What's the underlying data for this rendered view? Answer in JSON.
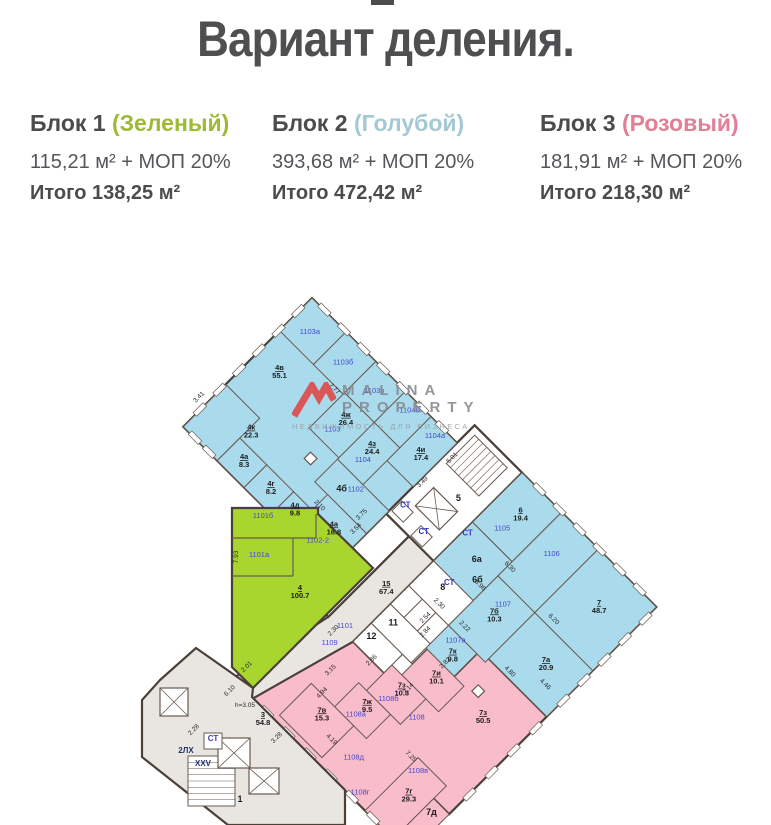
{
  "header": {
    "title": "Вариант деления."
  },
  "blocks": [
    {
      "name": "Блок 1",
      "color_label": "(Зеленый)",
      "color_hex": "#9cba34",
      "area_line": "115,21 м² + МОП 20%",
      "total_line": "Итого 138,25 м²"
    },
    {
      "name": "Блок 2",
      "color_label": "(Голубой)",
      "color_hex": "#a4c9d4",
      "area_line": "393,68 м² + МОП 20%",
      "total_line": "Итого 472,42 м²"
    },
    {
      "name": "Блок 3",
      "color_label": "(Розовый)",
      "color_hex": "#e07f96",
      "area_line": "181,91 м² + МОП 20%",
      "total_line": "Итого 218,30 м²"
    }
  ],
  "watermark": {
    "line1": "MALINA",
    "line2": "PROPERTY",
    "line3": "НЕДВИЖИМОСТЬ ДЛЯ БИЗНЕСА",
    "logo_color": "#e04545"
  },
  "floorplan": {
    "colors": {
      "b": "#a9dbec",
      "p": "#f8bccb",
      "g": "#a8d62e",
      "gray": "#e9e6e2",
      "w": "#ffffff",
      "wall": "#6a5a50",
      "outer": "#4a4038"
    },
    "pivot": {
      "x": 312,
      "y": 298,
      "angle": 45
    },
    "base_rot": [
      {
        "pts": "0,0 205,0 205,182 0,182",
        "f": "b"
      },
      {
        "pts": "205,-25 462,-25 462,130 205,130",
        "f": "b"
      },
      {
        "pts": "272,214 330,214 330,167 368,167 368,130 462,130 462,268 440,268 440,325 240,325",
        "f": "p"
      },
      {
        "pts": "237,75 272,75 272,214 240,330 212,330 237,214",
        "f": "gray"
      },
      {
        "pts": "205,100 237,100 237,214 205,214",
        "f": "w"
      },
      {
        "pts": "205,-25 272,-25 272,100 205,100",
        "f": "w"
      }
    ],
    "rects": [
      [
        0,
        0,
        48,
        46,
        "b",
        "room-1103a"
      ],
      [
        48,
        0,
        42,
        46,
        "b",
        "room-1103b"
      ],
      [
        90,
        0,
        42,
        44,
        "b",
        "room-1103v"
      ],
      [
        132,
        0,
        36,
        44,
        "b",
        "room-1104b"
      ],
      [
        168,
        0,
        37,
        62,
        "b",
        "room-1104a"
      ],
      [
        90,
        44,
        42,
        50,
        "b",
        "room-4zh"
      ],
      [
        132,
        44,
        36,
        52,
        "b",
        "room-4z"
      ],
      [
        132,
        96,
        73,
        32,
        "b",
        "room-4b-1102"
      ],
      [
        150,
        128,
        55,
        54,
        "b",
        "room-4a-16"
      ],
      [
        0,
        122,
        48,
        60,
        "b",
        "room-4k"
      ],
      [
        48,
        150,
        38,
        32,
        "b",
        "room-4a-8"
      ],
      [
        86,
        150,
        38,
        32,
        "b",
        "room-4g"
      ],
      [
        124,
        150,
        26,
        32,
        "b",
        "room-4d"
      ],
      [
        272,
        -25,
        56,
        70,
        "b",
        "room-6"
      ],
      [
        272,
        45,
        56,
        55,
        "b",
        "room-6a"
      ],
      [
        328,
        -25,
        52,
        90,
        "b",
        "room-1106"
      ],
      [
        380,
        -25,
        82,
        90,
        "b",
        "room-7"
      ],
      [
        328,
        65,
        52,
        70,
        "b",
        "room-7b"
      ],
      [
        380,
        65,
        82,
        65,
        "b",
        "room-7a"
      ],
      [
        328,
        135,
        40,
        32,
        "b",
        "room-1107a"
      ],
      [
        272,
        100,
        56,
        35,
        "w",
        "room-8"
      ],
      [
        272,
        135,
        19,
        26,
        "w",
        "wc"
      ],
      [
        291,
        135,
        19,
        26,
        "w",
        "wc"
      ],
      [
        310,
        135,
        18,
        26,
        "w",
        "wc"
      ],
      [
        272,
        161,
        56,
        27,
        "w",
        "room-11"
      ],
      [
        272,
        188,
        44,
        26,
        "w",
        "room-12"
      ],
      [
        316,
        188,
        14,
        26,
        "w",
        "wc"
      ],
      [
        330,
        167,
        52,
        36,
        "p",
        "room-7i"
      ],
      [
        316,
        203,
        48,
        36,
        "p",
        "room-7z10"
      ],
      [
        305,
        239,
        45,
        34,
        "p",
        "room-7zh"
      ],
      [
        272,
        273,
        60,
        45,
        "p",
        "room-7v"
      ],
      [
        400,
        250,
        40,
        75,
        "p",
        "room-7g"
      ],
      [
        440,
        268,
        22,
        57,
        "p",
        "room-7d"
      ]
    ],
    "columns": [
      [
        108,
        110,
        9,
        9
      ],
      [
        391,
        156,
        9,
        9
      ]
    ],
    "fixtures_rot": {
      "stairs": [
        [
          212,
          -18,
          46,
          40
        ]
      ],
      "elevators": [
        [
          220,
          48,
          34,
          26
        ]
      ],
      "boxes": [
        [
          207,
          80,
          16,
          14
        ],
        [
          238,
          84,
          16,
          14
        ]
      ]
    },
    "window_edges": [
      {
        "u": 6,
        "v": -3,
        "dir": "h",
        "len": 194,
        "n": 7
      },
      {
        "u": 285,
        "v": -28,
        "dir": "h",
        "len": 170,
        "n": 6
      },
      {
        "u": -3,
        "v": 8,
        "dir": "v",
        "len": 167,
        "n": 6
      },
      {
        "u": 460,
        "v": -20,
        "dir": "v",
        "len": 145,
        "n": 5
      },
      {
        "u": 460,
        "v": 135,
        "dir": "v",
        "len": 125,
        "n": 4
      },
      {
        "u": 250,
        "v": 322,
        "dir": "h",
        "len": 180,
        "n": 6
      },
      {
        "u": 5,
        "v": 179,
        "dir": "h",
        "len": 40,
        "n": 2
      }
    ],
    "unit_labels": [
      [
        24,
        27,
        "1103а"
      ],
      [
        69,
        25,
        "1103б"
      ],
      [
        111,
        23,
        "1103в"
      ],
      [
        150,
        12,
        "1104б"
      ],
      [
        186,
        12,
        "1104а"
      ],
      [
        109,
        80,
        "1103"
      ],
      [
        152,
        80,
        "1104"
      ],
      [
        168,
        106,
        "1102"
      ],
      [
        177,
        169,
        "1102-2"
      ],
      [
        299,
        30,
        "1105"
      ],
      [
        352,
        13,
        "1106"
      ],
      [
        353,
        83,
        "1107"
      ],
      [
        345,
        142,
        "1107а"
      ],
      [
        372,
        224,
        "1108"
      ],
      [
        327,
        265,
        "1108а"
      ],
      [
        339,
        231,
        "1108б"
      ],
      [
        411,
        261,
        "1108в"
      ],
      [
        385,
        317,
        "1108г"
      ],
      [
        356,
        297,
        "1108д"
      ],
      [
        258,
        233,
        "1109"
      ]
    ],
    "room_labels": [
      [
        28,
        74,
        "4в",
        "55.1"
      ],
      [
        50,
        136,
        "4к",
        "22.3"
      ],
      [
        108,
        60,
        "4ж",
        "26.4"
      ],
      [
        147,
        62,
        "4з",
        "24.4"
      ],
      [
        186,
        32,
        "4и",
        "17.4"
      ],
      [
        66,
        162,
        "4а",
        "8.3"
      ],
      [
        104,
        162,
        "4г",
        "8.2"
      ],
      [
        136,
        160,
        "4д",
        "9.8"
      ],
      [
        177,
        146,
        "4а",
        "16.8"
      ],
      [
        299,
        4,
        "6",
        "19.4"
      ],
      [
        420,
        14,
        "7",
        "48.7"
      ],
      [
        352,
        94,
        "7б",
        "10.3"
      ],
      [
        423,
        92,
        "7а",
        "20.9"
      ],
      [
        351,
        152,
        "7к",
        "9.8"
      ],
      [
        355,
        179,
        "7и",
        "10.1"
      ],
      [
        339,
        212,
        "7з",
        "10.3"
      ],
      [
        326,
        248,
        "7ж",
        "9.5"
      ],
      [
        416,
        174,
        "7з",
        "50.5"
      ],
      [
        300,
        286,
        "7в",
        "15.3"
      ],
      [
        419,
        282,
        "7г",
        "29.3"
      ],
      [
        256,
        151,
        "15",
        "67.4"
      ]
    ],
    "plain_labels": [
      [
        247,
        40,
        "5",
        "s"
      ],
      [
        299,
        114,
        "8",
        "s"
      ],
      [
        289,
        174,
        "11",
        "s"
      ],
      [
        283,
        199,
        "12",
        "s"
      ],
      [
        158,
        116,
        "4б",
        "s"
      ],
      [
        303,
        70,
        "6а",
        "s"
      ],
      [
        318,
        84,
        "6б",
        "s"
      ],
      [
        450,
        281,
        "7д",
        "s"
      ],
      [
        214,
        82,
        "СТ",
        "ct"
      ],
      [
        246,
        88,
        "СТ",
        "ct"
      ],
      [
        278,
        58,
        "СТ",
        "ct"
      ],
      [
        300,
        106,
        "СТ",
        "ct"
      ]
    ],
    "dims_rot": [
      [
        80,
        50,
        "7.77",
        0
      ],
      [
        152,
        143,
        "2.10",
        0
      ],
      [
        190,
        118,
        "3.75",
        1
      ],
      [
        196,
        132,
        "3.54",
        1
      ],
      [
        214,
        184,
        "4.61",
        1
      ],
      [
        210,
        52,
        "3.49",
        1
      ],
      [
        214,
        14,
        "5.01",
        1
      ],
      [
        330,
        52,
        "6.30",
        0
      ],
      [
        322,
        86,
        "5.96",
        0
      ],
      [
        398,
        58,
        "6.20",
        0
      ],
      [
        404,
        126,
        "4.80",
        0
      ],
      [
        438,
        110,
        "4.46",
        0
      ],
      [
        306,
        128,
        "2.30",
        0
      ],
      [
        340,
        126,
        "2.22",
        0
      ],
      [
        318,
        156,
        "2.84",
        1
      ],
      [
        354,
        164,
        "2.82",
        1
      ],
      [
        308,
        146,
        "2.54",
        1
      ],
      [
        300,
        214,
        "2.86",
        1
      ],
      [
        346,
        208,
        "2.14",
        1
      ],
      [
        394,
        256,
        "7.25",
        0
      ],
      [
        326,
        300,
        "4.19",
        0
      ],
      [
        278,
        250,
        "3.15",
        1
      ],
      [
        288,
        272,
        "4.94",
        1
      ],
      [
        -8,
        150,
        "3.41",
        1
      ],
      [
        252,
        220,
        "2.30",
        1
      ]
    ],
    "green": {
      "poly": "232,508 318,508 318,514 373,568 253,688 232,667",
      "walls": [
        [
          232,
          538,
          316,
          538
        ],
        [
          316,
          514,
          316,
          538
        ],
        [
          293,
          538,
          293,
          576
        ],
        [
          232,
          576,
          293,
          576
        ]
      ],
      "unit_labels": [
        [
          263,
          518,
          "1101б"
        ],
        [
          259,
          557,
          "1101а"
        ],
        [
          345,
          628,
          "1101"
        ]
      ],
      "room_labels": [
        [
          300,
          590,
          "4",
          "100.7"
        ]
      ],
      "dims": [
        [
          238,
          557,
          "7.93",
          -90
        ]
      ]
    },
    "annex": {
      "poly": "160,680 196,648 253,688 252,697 345,790 345,825 228,825 142,757 142,700",
      "stairs": [
        [
          188,
          756,
          47,
          50
        ]
      ],
      "elevators": [
        [
          218,
          738,
          32,
          30
        ],
        [
          249,
          768,
          30,
          26
        ],
        [
          160,
          688,
          28,
          28
        ]
      ],
      "boxes": [
        [
          204,
          733,
          18,
          16
        ]
      ],
      "labels": [
        [
          186,
          753,
          "2ЛХ",
          "s2",
          0
        ],
        [
          203,
          766,
          "XXV",
          "s2",
          0
        ],
        [
          240,
          802,
          "1",
          "s",
          0
        ],
        [
          213,
          741,
          "СТ",
          "ct",
          0
        ],
        [
          245,
          707,
          "h=3.05",
          "d",
          0
        ],
        [
          231,
          692,
          "6.10",
          "d",
          -45
        ],
        [
          195,
          731,
          "2.28",
          "d",
          -45
        ],
        [
          278,
          739,
          "3.28",
          "d",
          -45
        ],
        [
          248,
          668,
          "2.01",
          "d",
          -45
        ]
      ],
      "room_labels": [
        [
          263,
          717,
          "3",
          "54.8"
        ]
      ]
    }
  }
}
